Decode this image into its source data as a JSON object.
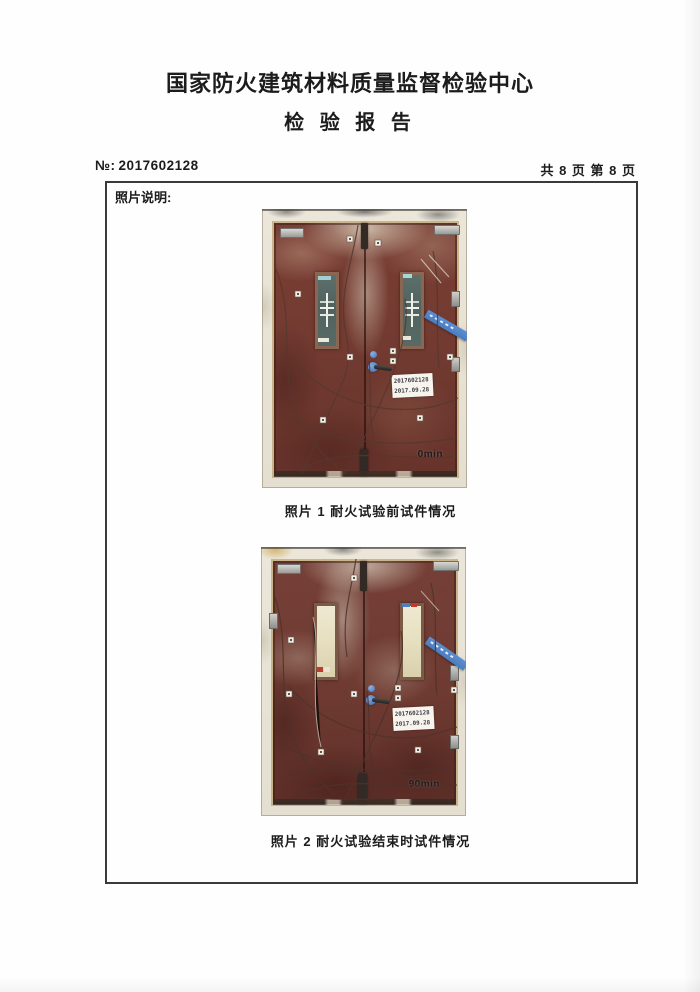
{
  "header": {
    "org_title": "国家防火建筑材料质量监督检验中心",
    "report_title": "检 验 报 告",
    "report_no": {
      "label": "№:",
      "value": "2017602128"
    },
    "page_info": "共 8 页 第 8 页"
  },
  "box": {
    "section_label": "照片说明:"
  },
  "photos": [
    {
      "caption": "照片 1 耐火试验前试件情况",
      "time_overlay": "0min",
      "spec_label": {
        "line1": "2017602128",
        "line2": "2017.09.28"
      }
    },
    {
      "caption": "照片 2 耐火试验结束时试件情况",
      "time_overlay": "90min",
      "spec_label": {
        "line1": "2017602128",
        "line2": "2017.09.28"
      }
    }
  ],
  "colors": {
    "ink": "#1c1c1c",
    "border": "#3a3a3a",
    "door": "#7a3e34",
    "insulation": "#ebe6d9",
    "tape": "#5d8ed2",
    "glass_before": "#51625f",
    "glass_after": "#e6dfc0"
  }
}
